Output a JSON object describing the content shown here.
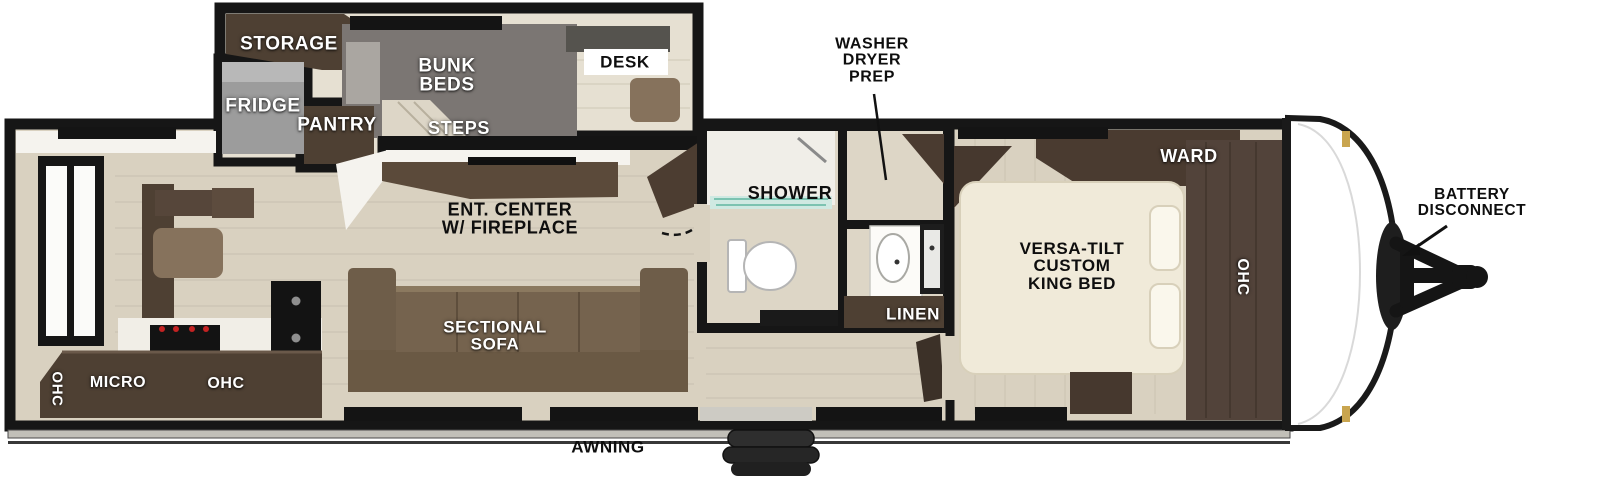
{
  "diagram": {
    "type": "travel-trailer-floorplan",
    "labels": {
      "storage": "STORAGE",
      "fridge": "FRIDGE",
      "pantry": "PANTRY",
      "bunk_beds": "BUNK\nBEDS",
      "steps": "STEPS",
      "desk": "DESK",
      "ent_center": "ENT. CENTER\nW/ FIREPLACE",
      "washer_dryer_prep": "WASHER\nDRYER\nPREP",
      "shower": "SHOWER",
      "linen": "LINEN",
      "ward": "WARD",
      "ohc_bedroom": "OHC",
      "king_bed": "VERSA-TILT\nCUSTOM\nKING BED",
      "battery_disconnect": "BATTERY\nDISCONNECT",
      "sectional_sofa": "SECTIONAL\nSOFA",
      "ohc_rear": "OHC",
      "micro": "MICRO",
      "ohc_kitchen": "OHC",
      "awning": "AWNING"
    },
    "colors": {
      "wall": "#161616",
      "floor_main": "#d9d1c0",
      "floor_upper": "#e6e0d2",
      "floor_bath": "#ddd6c6",
      "cabinet_dark": "#4e4033",
      "cabinet_wood": "#52433a",
      "sofa_brown": "#75634e",
      "chair_brown": "#86725c",
      "bunk_gray": "#7b7673",
      "fridge_gray": "#9c9c9c",
      "bed_cream": "#f0ead9",
      "glass_teal": "#7cc3b1",
      "awning_gray": "#c1bfb8",
      "hinge_gold": "#c9a54f",
      "label_white": "#ffffff",
      "label_black": "#111111"
    }
  }
}
